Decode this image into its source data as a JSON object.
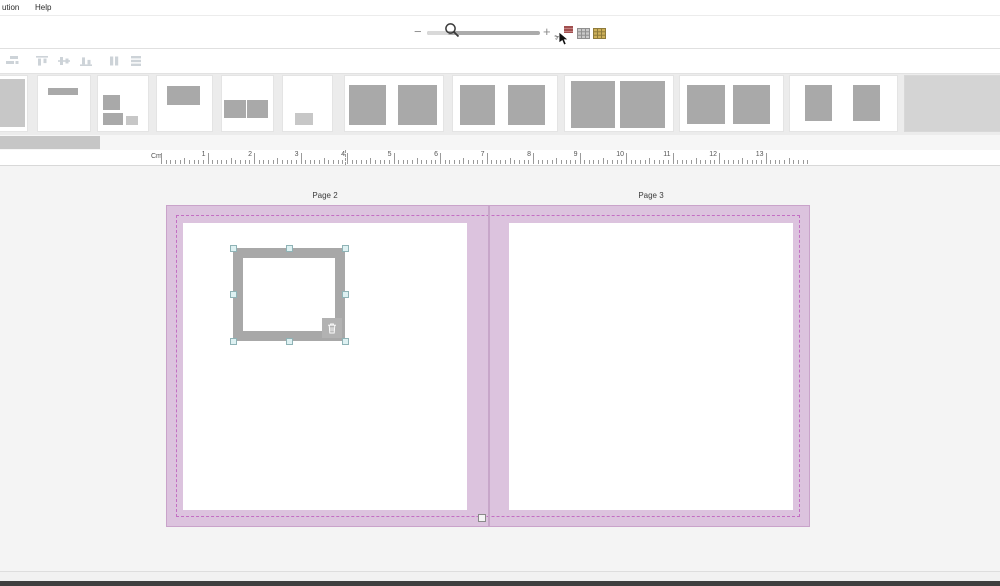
{
  "colors": {
    "canvas_bg": "#f4f4f4",
    "strip_bg": "#ececec",
    "spread_pink": "#dcc3de",
    "spread_border": "#c9a3ca",
    "bleed_dash": "#c36fc3",
    "box_gray": "#a9a9a9",
    "box_gray_light": "#c7c7c7",
    "frame_gray": "#a8a8a8",
    "handle_fill": "#def1f2",
    "handle_border": "#8fb3b6"
  },
  "menu": {
    "items": [
      {
        "label": "ution"
      },
      {
        "label": "Help"
      }
    ]
  },
  "zoom_toolbar": {
    "minus_label": "−",
    "plus_label": "+",
    "slider_position_pct": 20,
    "icons": [
      {
        "name": "cut-pages-icon",
        "glyph": "✂"
      },
      {
        "name": "grid-view-icon"
      },
      {
        "name": "pages-overview-icon"
      }
    ]
  },
  "align_toolbar": {
    "icon_color": "#cdd3d8",
    "icons": [
      {
        "name": "spread-order-icon",
        "x": 5
      },
      {
        "name": "align-top-icon",
        "x": 35
      },
      {
        "name": "align-middle-icon",
        "x": 57
      },
      {
        "name": "align-bottom-icon",
        "x": 79
      },
      {
        "name": "distribute-horizontal-icon",
        "x": 107
      },
      {
        "name": "distribute-vertical-icon",
        "x": 129
      }
    ]
  },
  "layout_strip": {
    "thumbnails": [
      {
        "name": "layout-thumb-full-bleed",
        "left": 0,
        "width": 27,
        "boxes": [
          {
            "x": 0,
            "y": 6,
            "w": 92,
            "h": 87,
            "shade": "light"
          }
        ]
      },
      {
        "name": "layout-thumb-title-bar",
        "left": 38,
        "width": 52,
        "boxes": [
          {
            "x": 19,
            "y": 21,
            "w": 58,
            "h": 13
          }
        ]
      },
      {
        "name": "layout-thumb-mixed-three",
        "left": 98,
        "width": 50,
        "boxes": [
          {
            "x": 10,
            "y": 34,
            "w": 34,
            "h": 28
          },
          {
            "x": 10,
            "y": 67,
            "w": 40,
            "h": 22
          },
          {
            "x": 56,
            "y": 72,
            "w": 24,
            "h": 17,
            "shade": "light"
          }
        ]
      },
      {
        "name": "layout-thumb-single-top",
        "left": 157,
        "width": 55,
        "boxes": [
          {
            "x": 18,
            "y": 18,
            "w": 60,
            "h": 35
          }
        ]
      },
      {
        "name": "layout-thumb-two-small",
        "left": 222,
        "width": 51,
        "boxes": [
          {
            "x": 4,
            "y": 44,
            "w": 43,
            "h": 32
          },
          {
            "x": 49,
            "y": 44,
            "w": 41,
            "h": 32
          }
        ]
      },
      {
        "name": "layout-thumb-caption-box",
        "left": 283,
        "width": 49,
        "boxes": [
          {
            "x": 24,
            "y": 67,
            "w": 37,
            "h": 22,
            "shade": "light"
          }
        ]
      },
      {
        "name": "layout-thumb-spread-two-a",
        "left": 345,
        "width": 98,
        "boxes": [
          {
            "x": 4,
            "y": 16,
            "w": 38,
            "h": 73
          },
          {
            "x": 54,
            "y": 16,
            "w": 40,
            "h": 73
          }
        ]
      },
      {
        "name": "layout-thumb-spread-two-b",
        "left": 453,
        "width": 104,
        "boxes": [
          {
            "x": 7,
            "y": 16,
            "w": 33,
            "h": 73
          },
          {
            "x": 53,
            "y": 16,
            "w": 35,
            "h": 73
          }
        ]
      },
      {
        "name": "layout-thumb-spread-two-c",
        "left": 565,
        "width": 108,
        "boxes": [
          {
            "x": 6,
            "y": 9,
            "w": 40,
            "h": 85
          },
          {
            "x": 51,
            "y": 9,
            "w": 42,
            "h": 85
          }
        ]
      },
      {
        "name": "layout-thumb-spread-two-d",
        "left": 680,
        "width": 103,
        "boxes": [
          {
            "x": 7,
            "y": 16,
            "w": 37,
            "h": 71
          },
          {
            "x": 51,
            "y": 16,
            "w": 36,
            "h": 71
          }
        ]
      },
      {
        "name": "layout-thumb-spread-two-e",
        "left": 790,
        "width": 107,
        "boxes": [
          {
            "x": 14,
            "y": 16,
            "w": 25,
            "h": 66
          },
          {
            "x": 59,
            "y": 16,
            "w": 25,
            "h": 66
          }
        ]
      },
      {
        "name": "layout-strip-end-panel",
        "left": 905,
        "width": 95,
        "panel": true,
        "boxes": []
      }
    ]
  },
  "ruler": {
    "unit_label": "Cm",
    "origin_x": 161,
    "px_per_cm": 46.5,
    "numbered_from": 1,
    "numbered_to": 13,
    "ticks_end_x": 810,
    "cursor_x": 345
  },
  "pages_view": {
    "page_labels": [
      "Page 2",
      "Page 3"
    ]
  }
}
